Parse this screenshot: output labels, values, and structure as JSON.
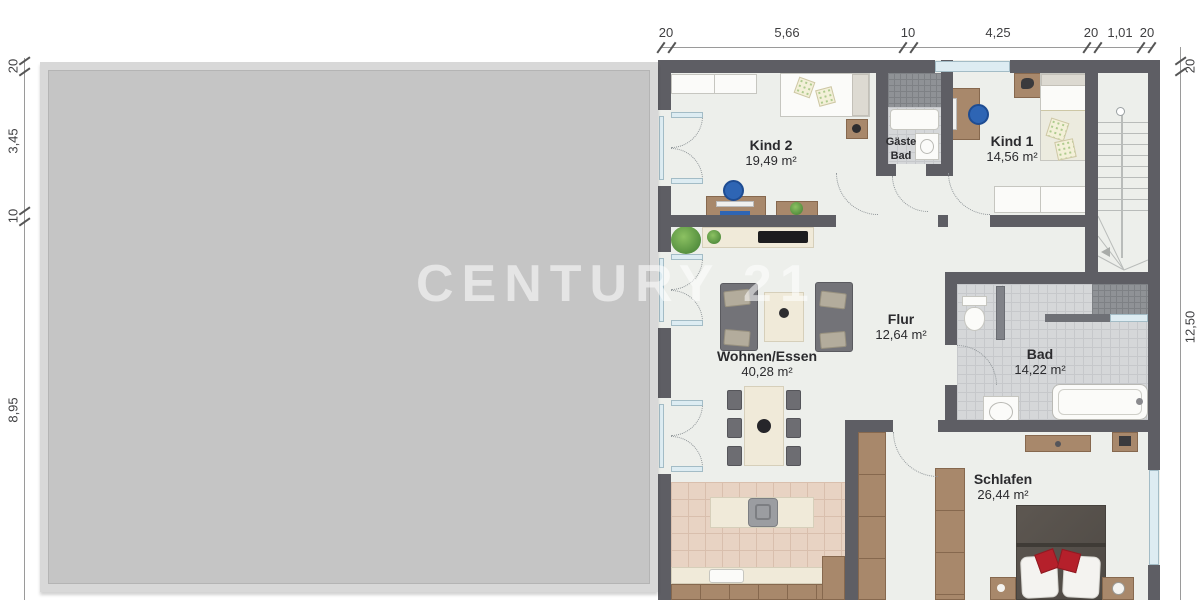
{
  "watermark": "CENTURY 21",
  "dimensions": {
    "top": [
      "20",
      "5,66",
      "10",
      "4,25",
      "20",
      "1,01",
      "20"
    ],
    "left": [
      "20",
      "3,45",
      "10",
      "8,95"
    ],
    "right": [
      "20",
      "12,50"
    ]
  },
  "rooms": {
    "kind2": {
      "name": "Kind 2",
      "area": "19,49 m²"
    },
    "gaeste_bad": {
      "name_line1": "Gäste",
      "name_line2": "Bad"
    },
    "kind1": {
      "name": "Kind 1",
      "area": "14,56 m²"
    },
    "flur": {
      "name": "Flur",
      "area": "12,64 m²"
    },
    "wohnen_essen": {
      "name": "Wohnen/Essen",
      "area": "40,28 m²"
    },
    "bad": {
      "name": "Bad",
      "area": "14,22 m²"
    },
    "schlafen": {
      "name": "Schlafen",
      "area": "26,44 m²"
    }
  },
  "colors": {
    "wall": "#5e5e64",
    "floor": "#edefeb",
    "bath_tile": "#d5d7d9",
    "kitchen_tile": "#e8d3c3",
    "wood": "#a8886b",
    "accent_blue": "#2e65b4",
    "accent_red": "#b5202b",
    "cover_gray": "#c5c5c5"
  }
}
